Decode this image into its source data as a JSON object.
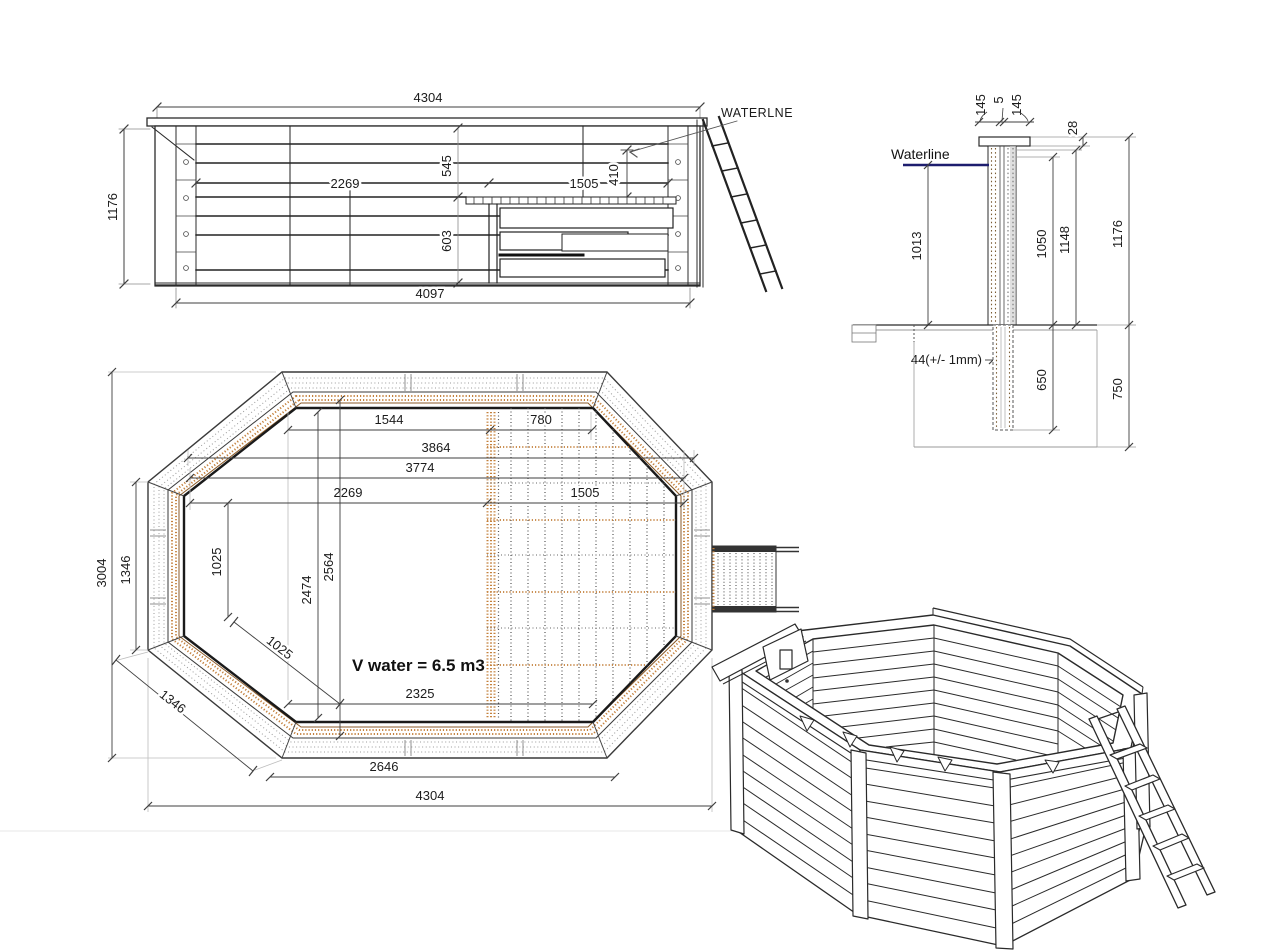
{
  "side_view": {
    "top_width": "4304",
    "bottom_width": "4097",
    "height": "1176",
    "inner_left_width": "2269",
    "inner_right_width": "1505",
    "top_depth": "545",
    "waterline_depth": "410",
    "bottom_depth": "603",
    "waterline_label": "WATERLNE"
  },
  "section_view": {
    "plank_left": "145",
    "plank_gap": "5",
    "plank_right": "145",
    "cap_height": "28",
    "waterline_label": "Waterline",
    "water_depth": "1013",
    "wall_inner_height": "1050",
    "wall_mid_height": "1148",
    "wall_total_height": "1176",
    "plank_thickness": "44(+/- 1mm)",
    "post_depth": "650",
    "foundation_depth": "750"
  },
  "plan_view": {
    "top_left_span": "1544",
    "top_right_span": "780",
    "inner_width_a": "3864",
    "inner_width_b": "3774",
    "left_inner_span": "2269",
    "right_inner_span": "1505",
    "total_height": "3004",
    "left_side_length": "1346",
    "left_inner_vertical": "1025",
    "diagonal_inner": "1025",
    "diagonal_side": "1346",
    "center_height_a": "2564",
    "center_height_b": "2474",
    "volume_label": "V water = 6.5 m3",
    "bottom_inner_span": "2325",
    "bottom_side_length": "2646",
    "total_width": "4304"
  },
  "colors": {
    "line": "#2b2b2b",
    "dim_line": "#3f3f3f",
    "wood_accent": "#c4813d",
    "wood_dark": "#8a5a28",
    "waterline_blue": "#1d1d6e",
    "background": "#ffffff"
  }
}
